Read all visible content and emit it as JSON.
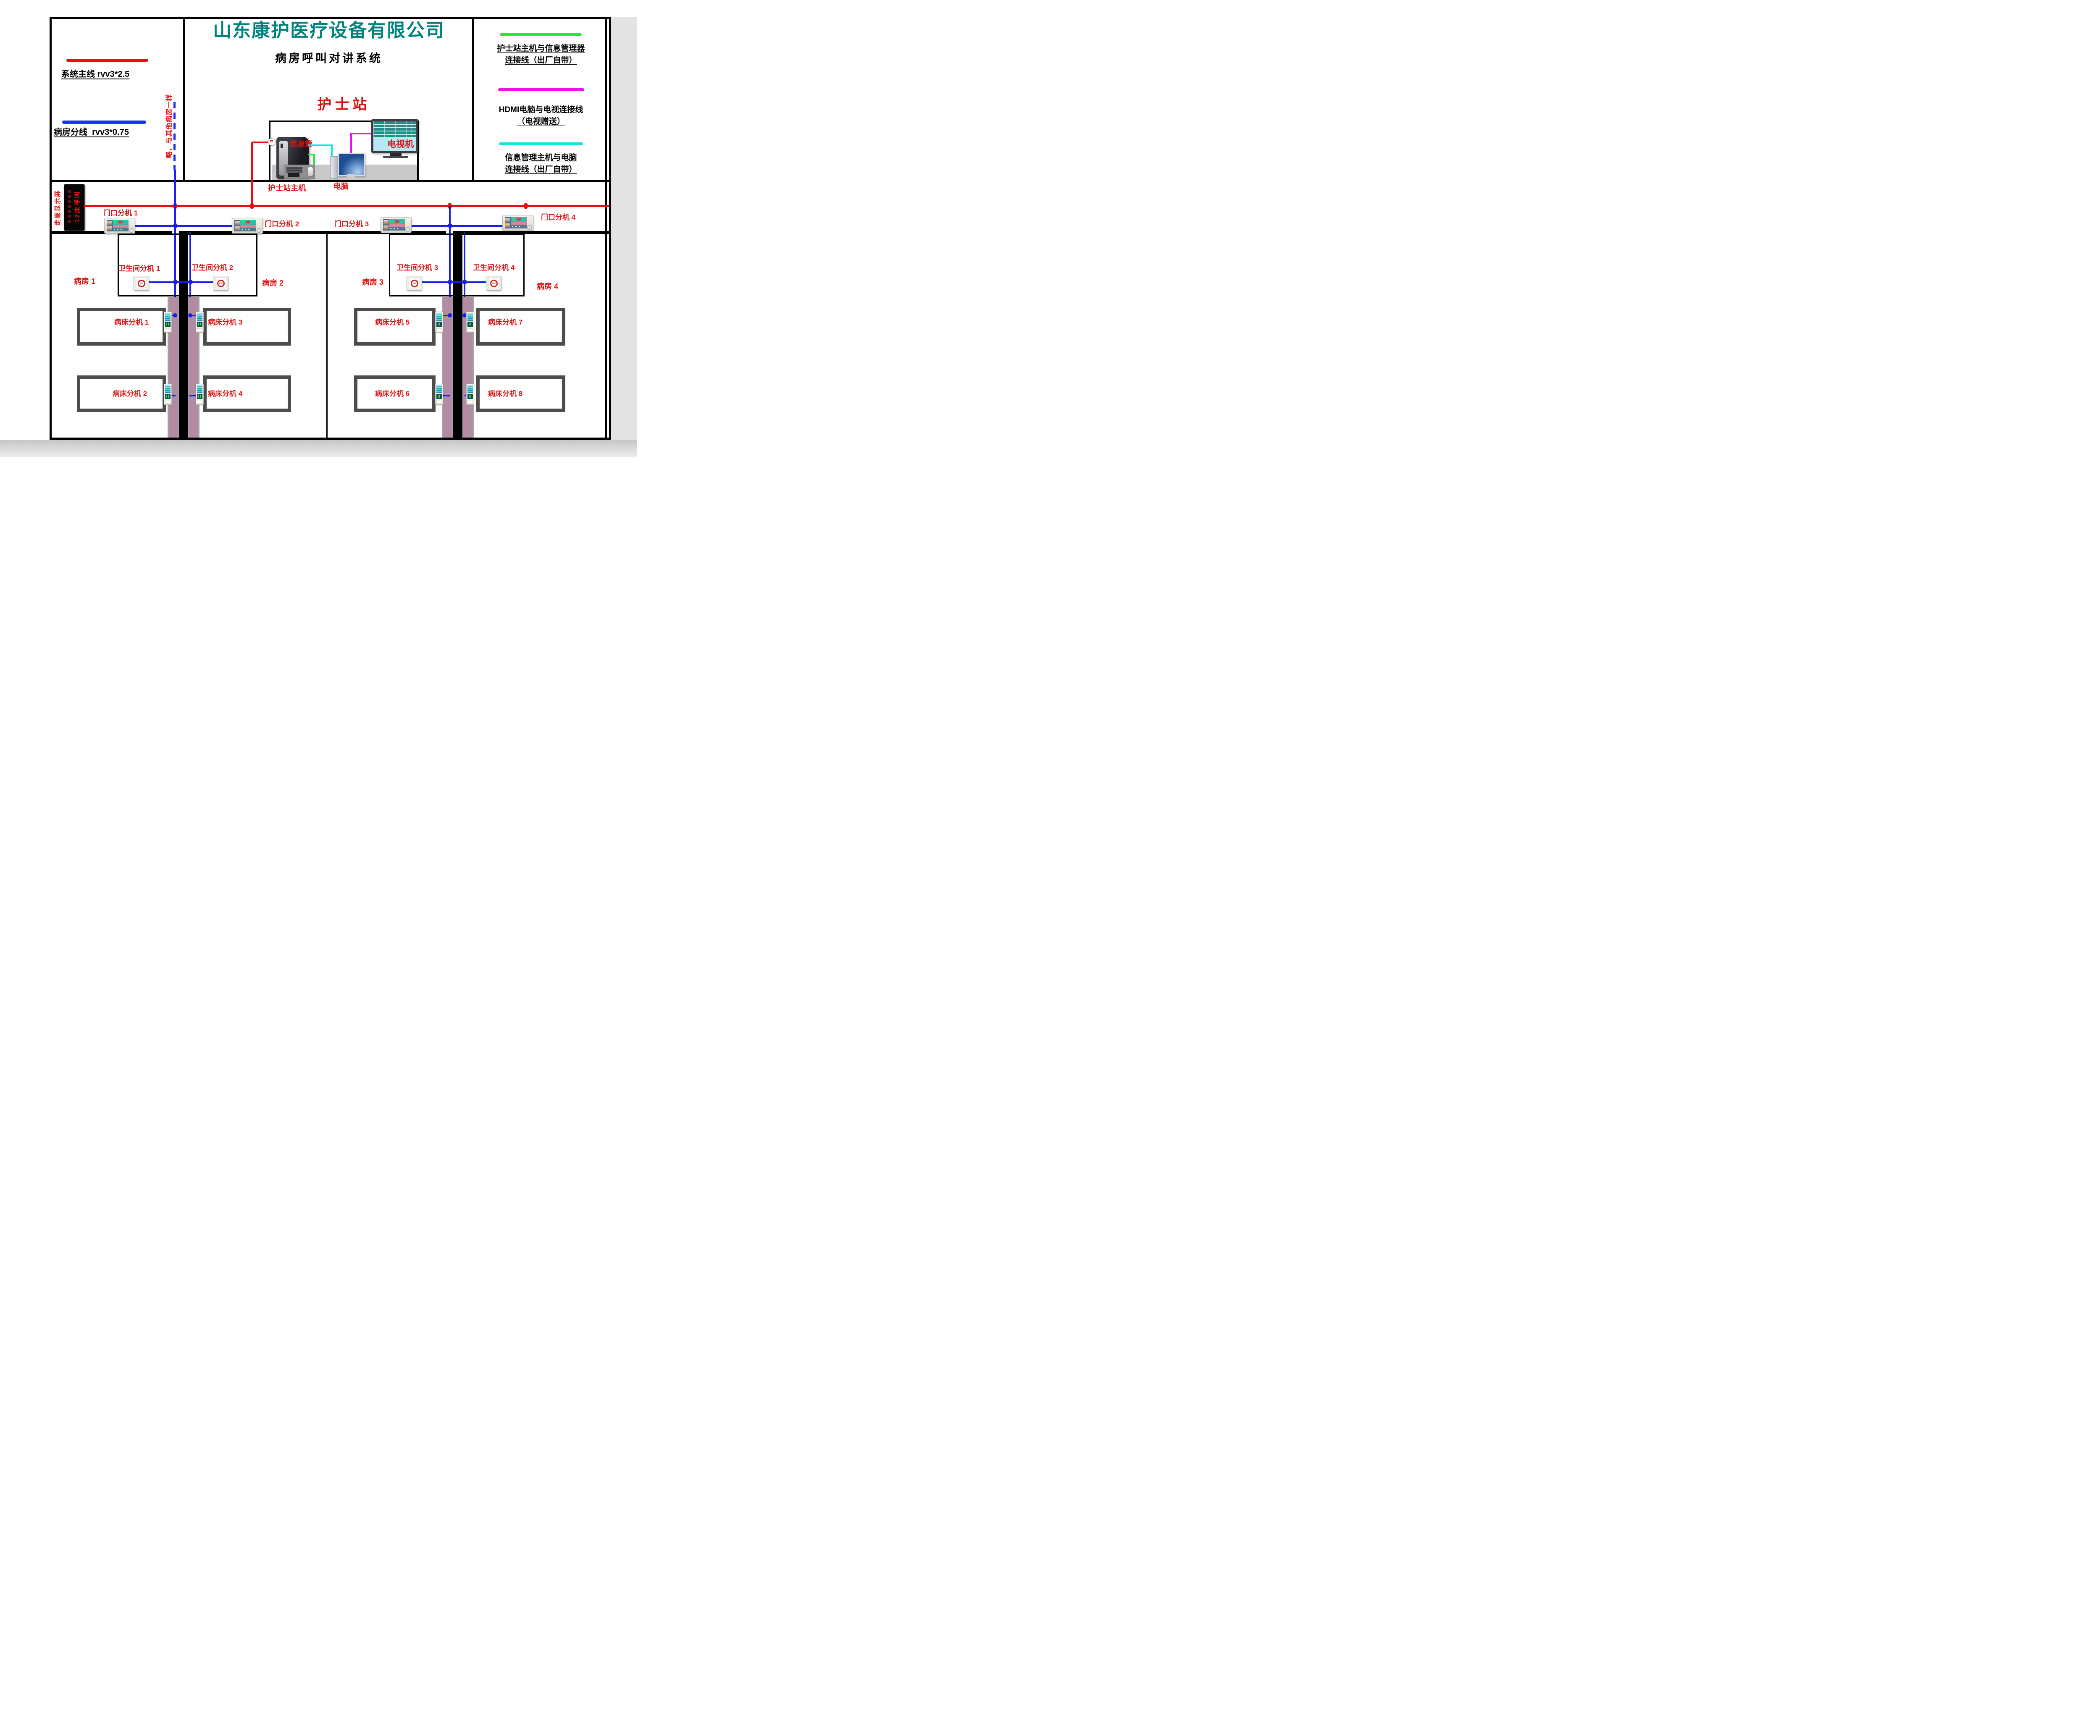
{
  "company": {
    "name": "山东康护医疗设备有限公司",
    "system_title": "病房呼叫对讲系统"
  },
  "legend_left": {
    "main_line_label": "系统主线 rvv3*2.5",
    "branch_line_label": "病房分线  rvv3*0.75",
    "main_line_color": "#ee0c0c",
    "branch_line_color": "#1c35f2"
  },
  "legend_right": {
    "items": [
      {
        "line1": "护士站主机与信息管理器",
        "line2": "连接线（出厂自带）",
        "color": "#2ae53c"
      },
      {
        "line1": "HDMI电脑与电视连接线",
        "line2": "（电视赠送）",
        "color": "#ea12ea"
      },
      {
        "line1": "信息管理主机与电脑",
        "line2": "连接线（出厂自带）",
        "color": "#12e6dc"
      }
    ]
  },
  "nurse_station": {
    "title": "护士站",
    "info_manager_label_line1": "信息管",
    "info_manager_label_line2": "理主机",
    "host_label": "护士站主机",
    "computer_label": "电脑",
    "tv_label": "电视机"
  },
  "corridor": {
    "display_label": "走廊显示屏",
    "led_text": "12床呼叫",
    "branch_note": "略，与其他病房一样",
    "door_screen_number": "12"
  },
  "door_units": [
    {
      "label": "门口分机 1"
    },
    {
      "label": "门口分机 2"
    },
    {
      "label": "门口分机 3"
    },
    {
      "label": "门口分机 4"
    }
  ],
  "wards": [
    {
      "label": "病房 1"
    },
    {
      "label": "病房 2"
    },
    {
      "label": "病房 3"
    },
    {
      "label": "病房 4"
    }
  ],
  "bathroom_units": [
    {
      "label": "卫生间分机 1"
    },
    {
      "label": "卫生间分机 2"
    },
    {
      "label": "卫生间分机 3"
    },
    {
      "label": "卫生间分机 4"
    }
  ],
  "bed_units": [
    {
      "label": "病床分机 1"
    },
    {
      "label": "病床分机 2"
    },
    {
      "label": "病床分机 3"
    },
    {
      "label": "病床分机 4"
    },
    {
      "label": "病床分机 5"
    },
    {
      "label": "病床分机 6"
    },
    {
      "label": "病床分机 7"
    },
    {
      "label": "病床分机 8"
    }
  ],
  "colors": {
    "title_teal": "#00827d",
    "label_red": "#dc1414",
    "main_line_red": "#ee0c0c",
    "branch_line_blue": "#1c1cf0",
    "nurse_info_link_green": "#2ae53c",
    "hdmi_link_magenta": "#ea12ea",
    "info_pc_link_cyan": "#12e6dc"
  }
}
